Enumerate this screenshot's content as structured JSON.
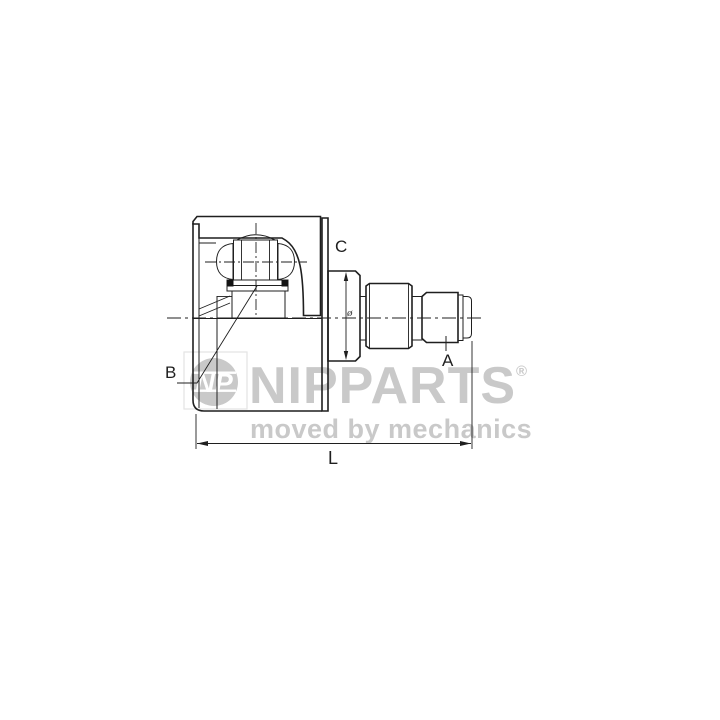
{
  "page": {
    "background": "#ffffff",
    "width": 720,
    "height": 720
  },
  "drawing": {
    "type": "technical-line-drawing",
    "subject": "inner CV joint housing (half-section) with splined stub shaft",
    "line_color": "#1f1f1f",
    "labels": {
      "a": "A",
      "b": "B",
      "c": "C",
      "l": "L",
      "diameter": "ø"
    }
  },
  "watermark": {
    "brand": "NIPPARTS",
    "registered_mark": "®",
    "tagline": "moved by mechanics",
    "monogram": "NP",
    "color": "#c9c9c9"
  }
}
